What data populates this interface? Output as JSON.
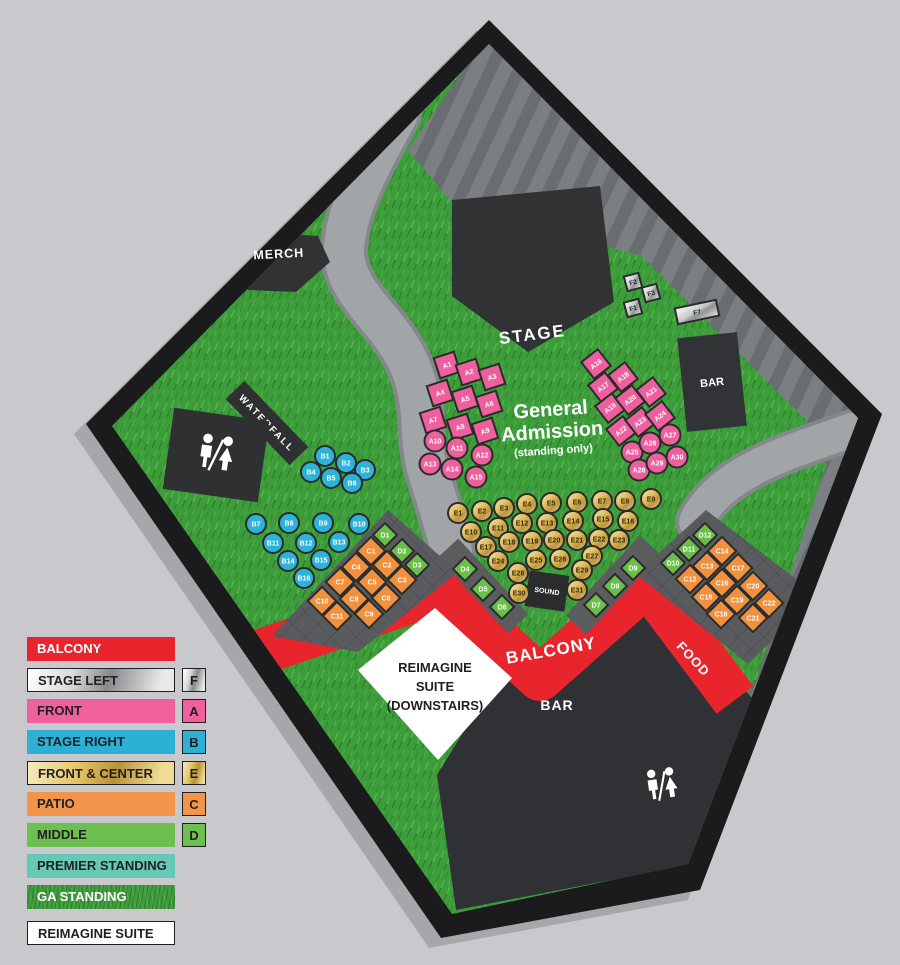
{
  "map": {
    "labels": {
      "stage": "STAGE",
      "merch": "MERCH",
      "waterfall": "WATERFALL",
      "bar_upper": "BAR",
      "bar_lower": "BAR",
      "food": "FOOD",
      "balcony": "BALCONY",
      "sound": "SOUND",
      "ga1": "General",
      "ga2": "Admission",
      "ga3": "(standing only)",
      "suite1": "REIMAGINE",
      "suite2": "SUITE",
      "suite3": "(DOWNSTAIRS)"
    },
    "sections": [
      {
        "id": "A",
        "name": "FRONT",
        "color": "#ee5f9e",
        "shape": "c",
        "cr": 10.5,
        "w": 21,
        "seats": [
          {
            "l": "A1",
            "x": 447,
            "y": 365,
            "s": "sq",
            "r": -18
          },
          {
            "l": "A2",
            "x": 469,
            "y": 372,
            "s": "sq",
            "r": -18
          },
          {
            "l": "A3",
            "x": 492,
            "y": 377,
            "s": "sq",
            "r": -18
          },
          {
            "l": "A4",
            "x": 440,
            "y": 393,
            "s": "sq",
            "r": -18
          },
          {
            "l": "A5",
            "x": 465,
            "y": 399,
            "s": "sq",
            "r": -18
          },
          {
            "l": "A6",
            "x": 489,
            "y": 404,
            "s": "sq",
            "r": -18
          },
          {
            "l": "A7",
            "x": 433,
            "y": 420,
            "s": "sq",
            "r": -18
          },
          {
            "l": "A8",
            "x": 460,
            "y": 427,
            "s": "sq",
            "r": -18
          },
          {
            "l": "A9",
            "x": 485,
            "y": 431,
            "s": "sq",
            "r": -18
          },
          {
            "l": "A10",
            "x": 435,
            "y": 441
          },
          {
            "l": "A11",
            "x": 457,
            "y": 448
          },
          {
            "l": "A12",
            "x": 482,
            "y": 455
          },
          {
            "l": "A13",
            "x": 430,
            "y": 464
          },
          {
            "l": "A14",
            "x": 452,
            "y": 469
          },
          {
            "l": "A15",
            "x": 476,
            "y": 477
          },
          {
            "l": "A16",
            "x": 596,
            "y": 364,
            "s": "sq",
            "r": -38
          },
          {
            "l": "A17",
            "x": 603,
            "y": 387,
            "s": "sq",
            "r": -38
          },
          {
            "l": "A18",
            "x": 623,
            "y": 377,
            "s": "sq",
            "r": -38
          },
          {
            "l": "A19",
            "x": 610,
            "y": 408,
            "s": "sq",
            "r": -38
          },
          {
            "l": "A20",
            "x": 630,
            "y": 400,
            "s": "sq",
            "r": -38
          },
          {
            "l": "A21",
            "x": 651,
            "y": 392,
            "s": "sq",
            "r": -38
          },
          {
            "l": "A22",
            "x": 621,
            "y": 431,
            "s": "sq",
            "r": -38
          },
          {
            "l": "A23",
            "x": 640,
            "y": 422,
            "s": "sq",
            "r": -38
          },
          {
            "l": "A24",
            "x": 660,
            "y": 416,
            "s": "sq",
            "r": -38
          },
          {
            "l": "A25",
            "x": 632,
            "y": 452
          },
          {
            "l": "A26",
            "x": 650,
            "y": 443
          },
          {
            "l": "A27",
            "x": 670,
            "y": 435
          },
          {
            "l": "A28",
            "x": 639,
            "y": 470
          },
          {
            "l": "A29",
            "x": 657,
            "y": 463
          },
          {
            "l": "A30",
            "x": 677,
            "y": 457
          }
        ]
      },
      {
        "id": "B",
        "name": "STAGE RIGHT",
        "color": "#2eb3d8",
        "shape": "c",
        "cr": 10,
        "seats": [
          {
            "l": "B1",
            "x": 325,
            "y": 456
          },
          {
            "l": "B2",
            "x": 346,
            "y": 463
          },
          {
            "l": "B3",
            "x": 365,
            "y": 470
          },
          {
            "l": "B4",
            "x": 311,
            "y": 472
          },
          {
            "l": "B5",
            "x": 331,
            "y": 478
          },
          {
            "l": "B6",
            "x": 352,
            "y": 483
          },
          {
            "l": "B7",
            "x": 256,
            "y": 524
          },
          {
            "l": "B8",
            "x": 289,
            "y": 523
          },
          {
            "l": "B9",
            "x": 323,
            "y": 523
          },
          {
            "l": "B10",
            "x": 359,
            "y": 524
          },
          {
            "l": "B11",
            "x": 273,
            "y": 543
          },
          {
            "l": "B12",
            "x": 306,
            "y": 543
          },
          {
            "l": "B13",
            "x": 339,
            "y": 542
          },
          {
            "l": "B14",
            "x": 288,
            "y": 561
          },
          {
            "l": "B15",
            "x": 321,
            "y": 560
          },
          {
            "l": "B16",
            "x": 304,
            "y": 578
          }
        ]
      },
      {
        "id": "C",
        "name": "PATIO",
        "color": "#f0913f",
        "shape": "d",
        "w": 20,
        "seats": [
          {
            "l": "C1",
            "x": 371,
            "y": 551
          },
          {
            "l": "C2",
            "x": 387,
            "y": 565
          },
          {
            "l": "C3",
            "x": 402,
            "y": 580
          },
          {
            "l": "C4",
            "x": 356,
            "y": 567
          },
          {
            "l": "C5",
            "x": 372,
            "y": 582
          },
          {
            "l": "C6",
            "x": 386,
            "y": 598
          },
          {
            "l": "C7",
            "x": 340,
            "y": 582
          },
          {
            "l": "C8",
            "x": 354,
            "y": 599
          },
          {
            "l": "C9",
            "x": 369,
            "y": 614
          },
          {
            "l": "C10",
            "x": 322,
            "y": 601
          },
          {
            "l": "C11",
            "x": 337,
            "y": 616
          },
          {
            "l": "C12",
            "x": 690,
            "y": 579
          },
          {
            "l": "C13",
            "x": 707,
            "y": 566
          },
          {
            "l": "C14",
            "x": 722,
            "y": 551
          },
          {
            "l": "C15",
            "x": 706,
            "y": 597
          },
          {
            "l": "C16",
            "x": 722,
            "y": 583
          },
          {
            "l": "C17",
            "x": 738,
            "y": 568
          },
          {
            "l": "C18",
            "x": 721,
            "y": 614
          },
          {
            "l": "C19",
            "x": 737,
            "y": 600
          },
          {
            "l": "C20",
            "x": 753,
            "y": 586
          },
          {
            "l": "C21",
            "x": 753,
            "y": 618
          },
          {
            "l": "C22",
            "x": 769,
            "y": 603
          }
        ]
      },
      {
        "id": "D",
        "name": "MIDDLE",
        "color": "#6abf4a",
        "shape": "d",
        "w": 17,
        "seats": [
          {
            "l": "D1",
            "x": 385,
            "y": 535
          },
          {
            "l": "D2",
            "x": 402,
            "y": 551
          },
          {
            "l": "D3",
            "x": 417,
            "y": 565
          },
          {
            "l": "D4",
            "x": 465,
            "y": 569
          },
          {
            "l": "D5",
            "x": 483,
            "y": 589
          },
          {
            "l": "D6",
            "x": 502,
            "y": 607
          },
          {
            "l": "D7",
            "x": 596,
            "y": 605
          },
          {
            "l": "D8",
            "x": 615,
            "y": 586
          },
          {
            "l": "D9",
            "x": 633,
            "y": 568
          },
          {
            "l": "D10",
            "x": 673,
            "y": 563
          },
          {
            "l": "D11",
            "x": 689,
            "y": 549
          },
          {
            "l": "D12",
            "x": 705,
            "y": 535
          }
        ]
      },
      {
        "id": "E",
        "name": "FRONT & CENTER",
        "color": "#d4aa4e",
        "shape": "c",
        "cr": 10,
        "seats": [
          {
            "l": "E1",
            "x": 458,
            "y": 513
          },
          {
            "l": "E2",
            "x": 482,
            "y": 511
          },
          {
            "l": "E3",
            "x": 504,
            "y": 508
          },
          {
            "l": "E4",
            "x": 527,
            "y": 504
          },
          {
            "l": "E5",
            "x": 551,
            "y": 503
          },
          {
            "l": "E6",
            "x": 577,
            "y": 502
          },
          {
            "l": "E7",
            "x": 602,
            "y": 501
          },
          {
            "l": "E8",
            "x": 625,
            "y": 501
          },
          {
            "l": "E9",
            "x": 651,
            "y": 499
          },
          {
            "l": "E10",
            "x": 471,
            "y": 532
          },
          {
            "l": "E11",
            "x": 498,
            "y": 528
          },
          {
            "l": "E12",
            "x": 522,
            "y": 523
          },
          {
            "l": "E13",
            "x": 547,
            "y": 523
          },
          {
            "l": "E14",
            "x": 573,
            "y": 521
          },
          {
            "l": "E15",
            "x": 603,
            "y": 519
          },
          {
            "l": "E16",
            "x": 628,
            "y": 521
          },
          {
            "l": "E17",
            "x": 486,
            "y": 547
          },
          {
            "l": "E18",
            "x": 509,
            "y": 542
          },
          {
            "l": "E19",
            "x": 532,
            "y": 541
          },
          {
            "l": "E20",
            "x": 554,
            "y": 540
          },
          {
            "l": "E21",
            "x": 577,
            "y": 540
          },
          {
            "l": "E22",
            "x": 599,
            "y": 539
          },
          {
            "l": "E23",
            "x": 619,
            "y": 540
          },
          {
            "l": "E24",
            "x": 498,
            "y": 561
          },
          {
            "l": "E25",
            "x": 536,
            "y": 560
          },
          {
            "l": "E26",
            "x": 560,
            "y": 559
          },
          {
            "l": "E27",
            "x": 592,
            "y": 556
          },
          {
            "l": "E28",
            "x": 518,
            "y": 573
          },
          {
            "l": "E29",
            "x": 582,
            "y": 570
          },
          {
            "l": "E30",
            "x": 519,
            "y": 593
          },
          {
            "l": "E31",
            "x": 577,
            "y": 590
          }
        ]
      },
      {
        "id": "F",
        "name": "STAGE LEFT",
        "color": "#b9bbbd",
        "shape": "sq",
        "w": 15,
        "seats": [
          {
            "l": "F1",
            "x": 633,
            "y": 308,
            "s": "sq",
            "r": -15
          },
          {
            "l": "F2",
            "x": 633,
            "y": 282,
            "s": "sq",
            "r": -15
          },
          {
            "l": "F3",
            "x": 651,
            "y": 293,
            "s": "sq",
            "r": -15
          },
          {
            "l": "F7",
            "x": 697,
            "y": 312,
            "s": "sq",
            "r": -12,
            "w": 42,
            "h": 16
          }
        ]
      }
    ]
  },
  "legend": {
    "items": [
      {
        "label": "BALCONY"
      },
      {
        "label": "STAGE LEFT",
        "badge": "F"
      },
      {
        "label": "FRONT",
        "badge": "A"
      },
      {
        "label": "STAGE RIGHT",
        "badge": "B"
      },
      {
        "label": "FRONT & CENTER",
        "badge": "E"
      },
      {
        "label": "PATIO",
        "badge": "C"
      },
      {
        "label": "MIDDLE",
        "badge": "D"
      },
      {
        "label": "PREMIER STANDING"
      },
      {
        "label": "GA STANDING"
      },
      {
        "label": "REIMAGINE SUITE"
      }
    ]
  },
  "colors": {
    "balcony_red": "#e8252c",
    "front_pink": "#ee5f9e",
    "stage_right_blue": "#2eb3d8",
    "patio_orange": "#f0913f",
    "middle_green": "#6abf4a",
    "premier_teal": "#66c9b5",
    "grass_green": "#3e9d3b",
    "deck_gray": "#595b5e",
    "background": "#c9c9cd"
  }
}
